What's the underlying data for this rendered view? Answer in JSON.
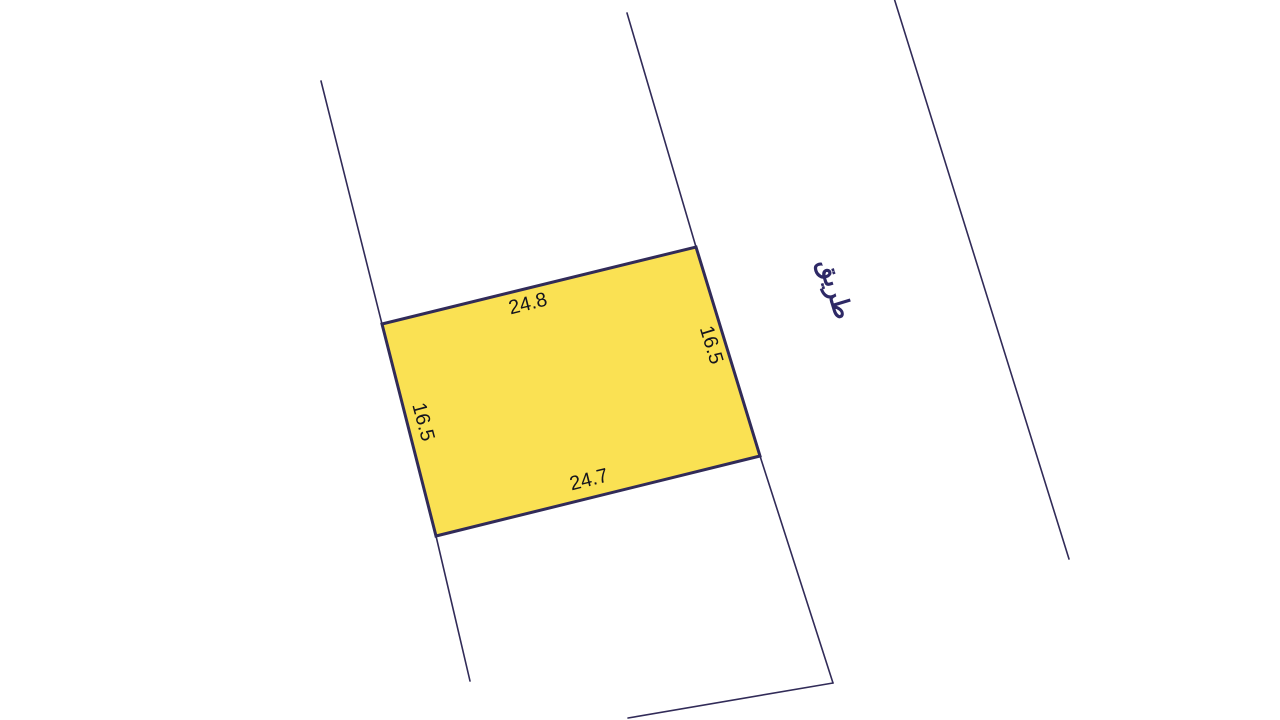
{
  "canvas": {
    "width": 1280,
    "height": 720,
    "background": "#ffffff"
  },
  "colors": {
    "parcel_fill": "#FAE153",
    "parcel_stroke": "#312B58",
    "boundary_stroke": "#312B58",
    "dimension_text": "#15151D",
    "road_text": "#2E2966"
  },
  "parcel": {
    "points": [
      [
        382,
        324
      ],
      [
        696,
        247
      ],
      [
        760,
        456
      ],
      [
        436,
        536
      ]
    ],
    "dimensions": [
      {
        "side": "top",
        "label": "24.8",
        "x": 528,
        "y": 304,
        "rotation": -14
      },
      {
        "side": "right",
        "label": "16.5",
        "x": 711,
        "y": 345,
        "rotation": 73
      },
      {
        "side": "bottom",
        "label": "24.7",
        "x": 589,
        "y": 480,
        "rotation": -14
      },
      {
        "side": "left",
        "label": "16.5",
        "x": 423,
        "y": 422,
        "rotation": 75
      }
    ]
  },
  "boundaries": [
    {
      "name": "west-plot-boundary",
      "points": [
        [
          321,
          81
        ],
        [
          382,
          324
        ],
        [
          436,
          536
        ],
        [
          470,
          681
        ]
      ]
    },
    {
      "name": "road-west-boundary",
      "points": [
        [
          627,
          13
        ],
        [
          696,
          247
        ],
        [
          760,
          456
        ],
        [
          833,
          683
        ]
      ]
    },
    {
      "name": "road-east-boundary",
      "points": [
        [
          894,
          -2
        ],
        [
          1069,
          559
        ]
      ]
    },
    {
      "name": "south-plot-boundary",
      "points": [
        [
          833,
          683
        ],
        [
          628,
          718
        ]
      ]
    }
  ],
  "road_label": {
    "text": "طريق",
    "x": 835,
    "y": 289,
    "rotation": 73
  }
}
